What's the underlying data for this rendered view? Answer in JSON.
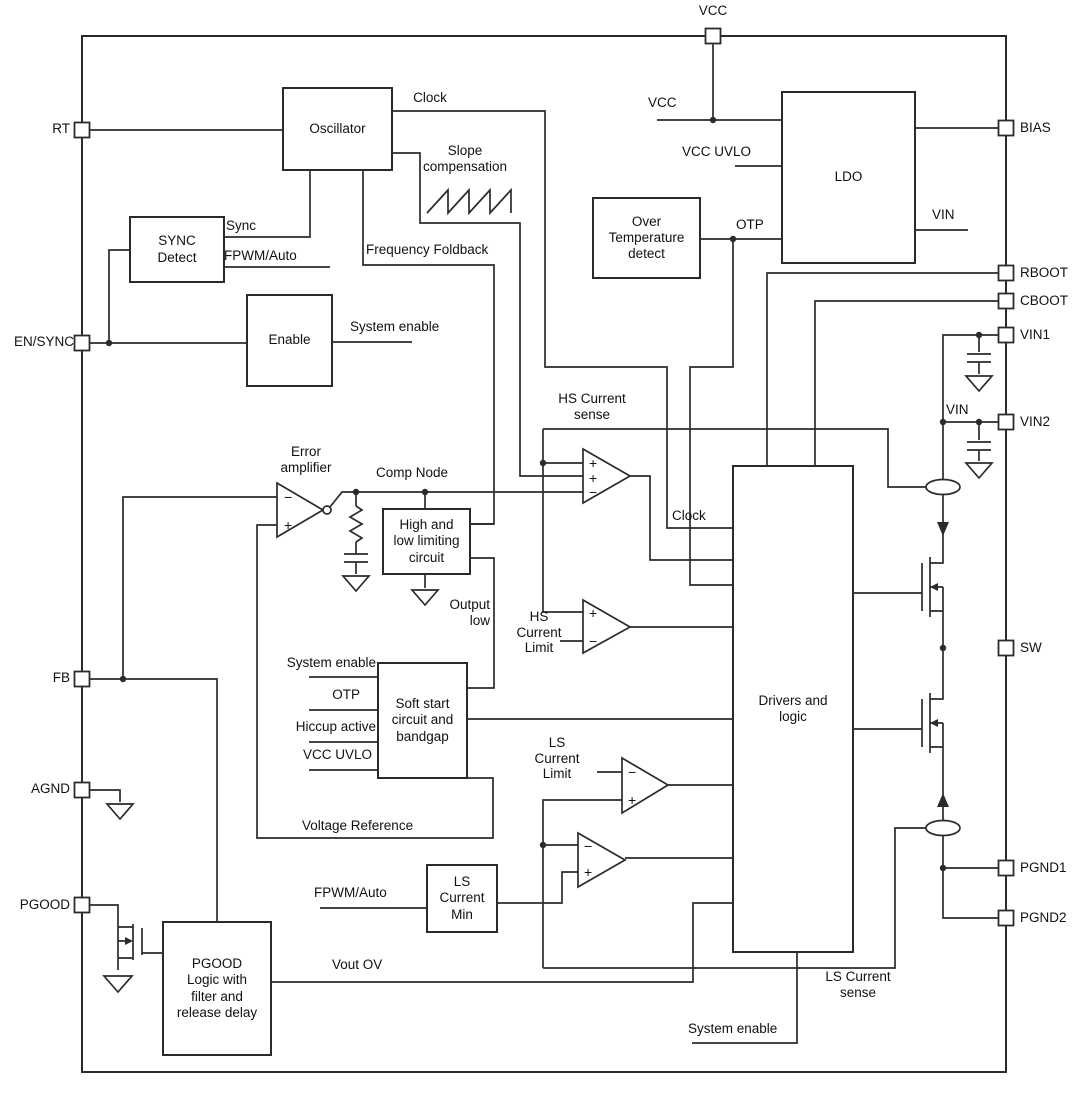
{
  "colors": {
    "line": "#2b2b2b",
    "text": "#111111",
    "background": "#ffffff"
  },
  "pins": {
    "vcc": "VCC",
    "rt": "RT",
    "en_sync": "EN/SYNC",
    "fb": "FB",
    "agnd": "AGND",
    "pgood": "PGOOD",
    "bias": "BIAS",
    "rboot": "RBOOT",
    "cboot": "CBOOT",
    "vin1": "VIN1",
    "vin2": "VIN2",
    "sw": "SW",
    "pgnd1": "PGND1",
    "pgnd2": "PGND2"
  },
  "blocks": {
    "oscillator": "Oscillator",
    "sync_detect": "SYNC\nDetect",
    "enable": "Enable",
    "over_temp": "Over\nTemperature\ndetect",
    "ldo": "LDO",
    "high_low": "High and\nlow limiting\ncircuit",
    "soft_start": "Soft start\ncircuit and\nbandgap",
    "ls_current_min": "LS\nCurrent\nMin",
    "pgood_logic": "PGOOD\nLogic with\nfilter and\nrelease delay",
    "drivers": "Drivers and\nlogic"
  },
  "labels": {
    "clock_osc": "Clock",
    "clock_drv": "Clock",
    "sync": "Sync",
    "fpwm_auto_top": "FPWM/Auto",
    "fpwm_auto_bot": "FPWM/Auto",
    "slope_compensation": "Slope\ncompensation",
    "frequency_foldback": "Frequency Foldback",
    "system_enable_en": "System enable",
    "system_enable_ss": "System enable",
    "system_enable_drv": "System enable",
    "error_amplifier": "Error\namplifier",
    "comp_node": "Comp Node",
    "output_low": "Output\nlow",
    "hs_current_sense": "HS Current\nsense",
    "hs_current_limit": "HS\nCurrent\nLimit",
    "ls_current_limit": "LS\nCurrent\nLimit",
    "ls_current_sense": "LS Current\nsense",
    "voltage_reference": "Voltage Reference",
    "vout_ov": "Vout OV",
    "otp_ldo": "OTP",
    "otp_ss": "OTP",
    "hiccup_active": "Hiccup active",
    "vcc_uvlo_ldo": "VCC UVLO",
    "vcc_uvlo_ss": "VCC UVLO",
    "vcc_pin": "VCC",
    "vcc_ldo": "VCC",
    "vin_ldo": "VIN",
    "vin_rail": "VIN"
  },
  "sym": {
    "plus": "+",
    "minus": "−"
  }
}
